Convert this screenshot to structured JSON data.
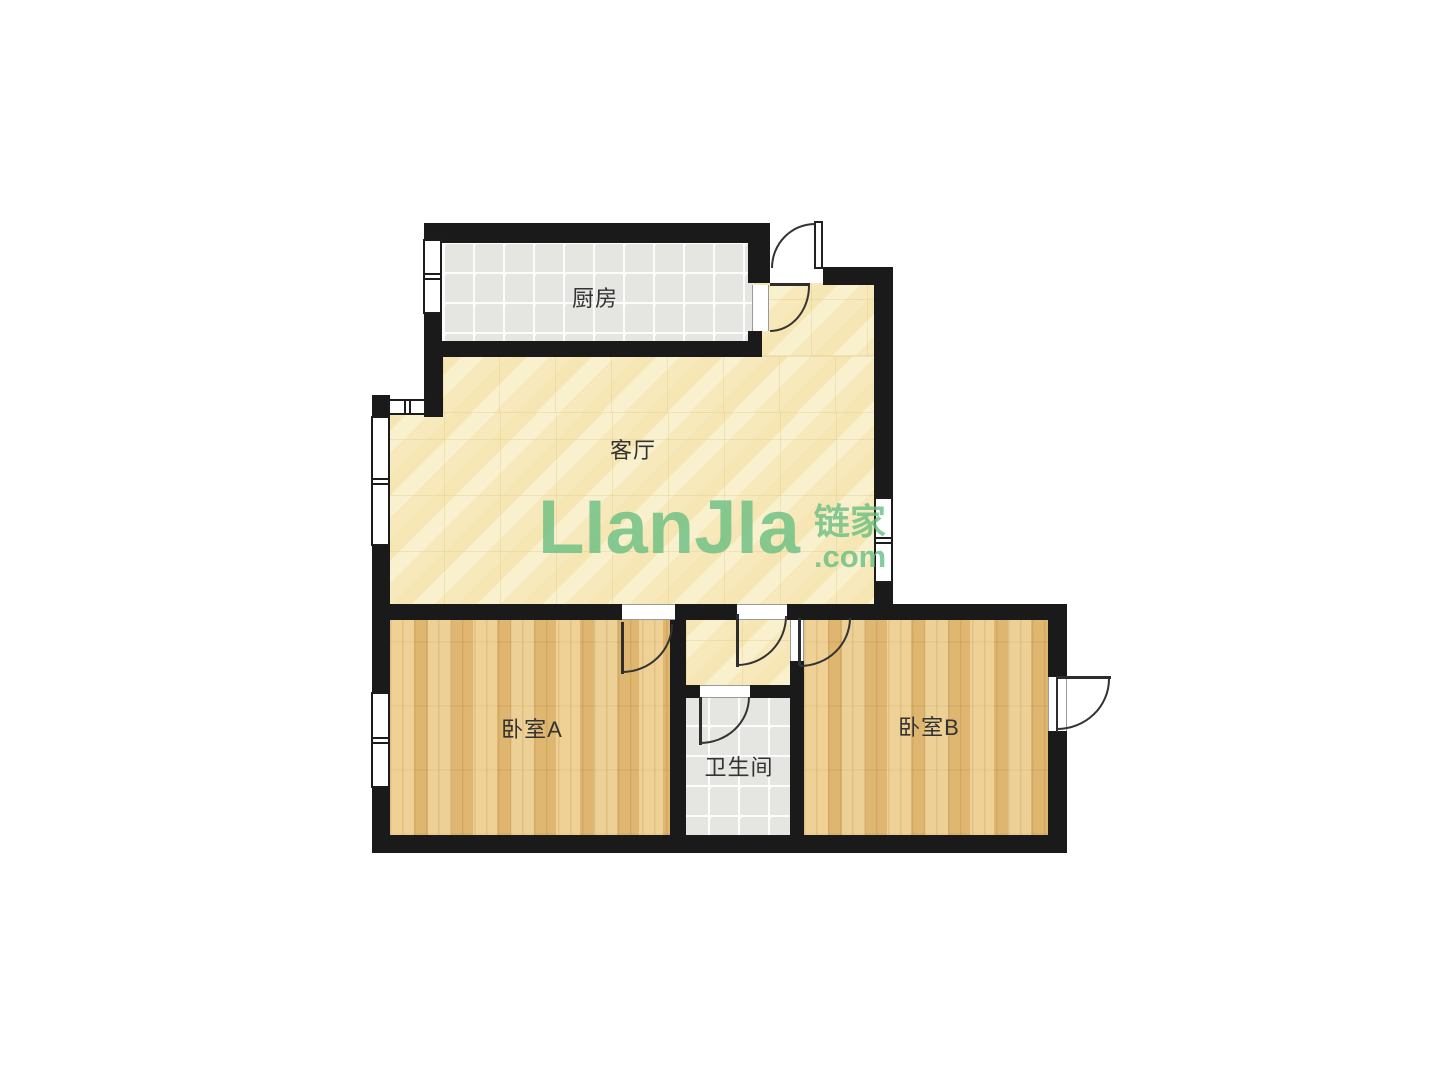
{
  "watermark": {
    "logo": "LIanJIa",
    "cjk": "链家",
    "domain": ".com"
  },
  "rooms": {
    "kitchen": {
      "label": "厨房"
    },
    "living": {
      "label": "客厅"
    },
    "bedroom_a": {
      "label": "卧室A"
    },
    "bathroom": {
      "label": "卫生间"
    },
    "bedroom_b": {
      "label": "卧室B"
    }
  },
  "colors": {
    "wall": "#1a1a1a",
    "wood_floor": "#e6c07a",
    "marble_floor": "#f8edc5",
    "tile_floor": "#e5e5e1",
    "label_text": "#333333",
    "watermark_green": "#68be82"
  }
}
